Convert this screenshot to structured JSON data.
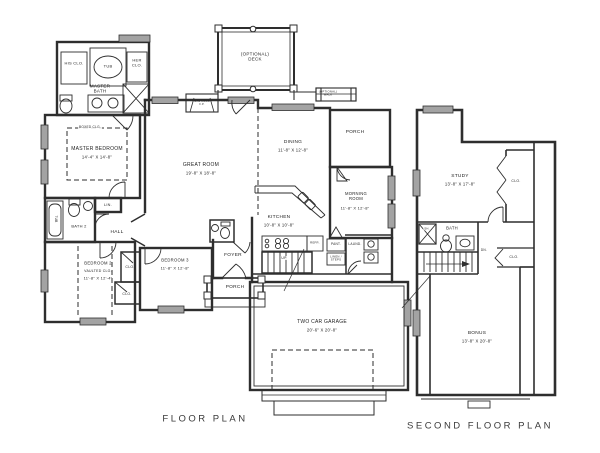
{
  "drawing": {
    "colors": {
      "line": "#2e2e2e",
      "window_fill": "#a3a3a3",
      "background": "#ffffff"
    }
  },
  "first_floor": {
    "caption": "FLOOR PLAN",
    "labels": {
      "his_clo": "HIS CLO.",
      "tub_master": "TUB",
      "her_clo": "HER CLO.",
      "master_bath": "MASTER BATH",
      "master_bedroom": "MASTER BEDROOM",
      "master_bedroom_dims": "14'-4\" X 14'-8\"",
      "master_bedroom_clg": "BOXED CLG.",
      "fireplace": "GAS LOGS F.P.",
      "optional_deck": "(OPTIONAL) DECK",
      "optional_walk": "(OPTIONAL) WALK",
      "great_room": "GREAT ROOM",
      "great_room_dims": "19'-8\" X 18'-8\"",
      "dining": "DINING",
      "dining_dims": "11'-8\" X 12'-8\"",
      "porch_rear": "PORCH",
      "morning_room": "MORNING ROOM",
      "morning_room_dims": "11'-8\" X 12'-8\"",
      "kitchen": "KITCHEN",
      "kitchen_dims": "10'-8\" X 10'-8\"",
      "refr": "REFR.",
      "pant": "PANT.",
      "laund": "LAUND.",
      "linen_steps": "LINEN / STEPS",
      "up": "UP",
      "tub_bath2": "TUB",
      "bath2": "BATH 2",
      "lin": "LIN.",
      "hall": "HALL",
      "bedroom2": "BEDROOM 2",
      "bedroom2_clg": "VAULTED CLG.",
      "bedroom2_dims": "11'-8\" X 12'-4\"",
      "bedroom3": "BEDROOM 3",
      "bedroom3_dims": "11'-8\" X 12'-8\"",
      "clo_a": "CLO.",
      "clo_b": "CLO.",
      "foyer": "FOYER",
      "porch_front": "PORCH",
      "garage": "TWO CAR GARAGE",
      "garage_dims": "20'-6\" X 20'-8\""
    }
  },
  "second_floor": {
    "caption": "SECOND FLOOR PLAN",
    "labels": {
      "study": "STUDY",
      "study_dims": "13'-8\" X 17'-8\"",
      "clo_study": "CLO.",
      "sh": "SH.",
      "bath": "BATH",
      "dn": "DN.",
      "clo_hall": "CLO.",
      "bonus": "BONUS",
      "bonus_dims": "13'-8\" X 20'-8\""
    }
  }
}
